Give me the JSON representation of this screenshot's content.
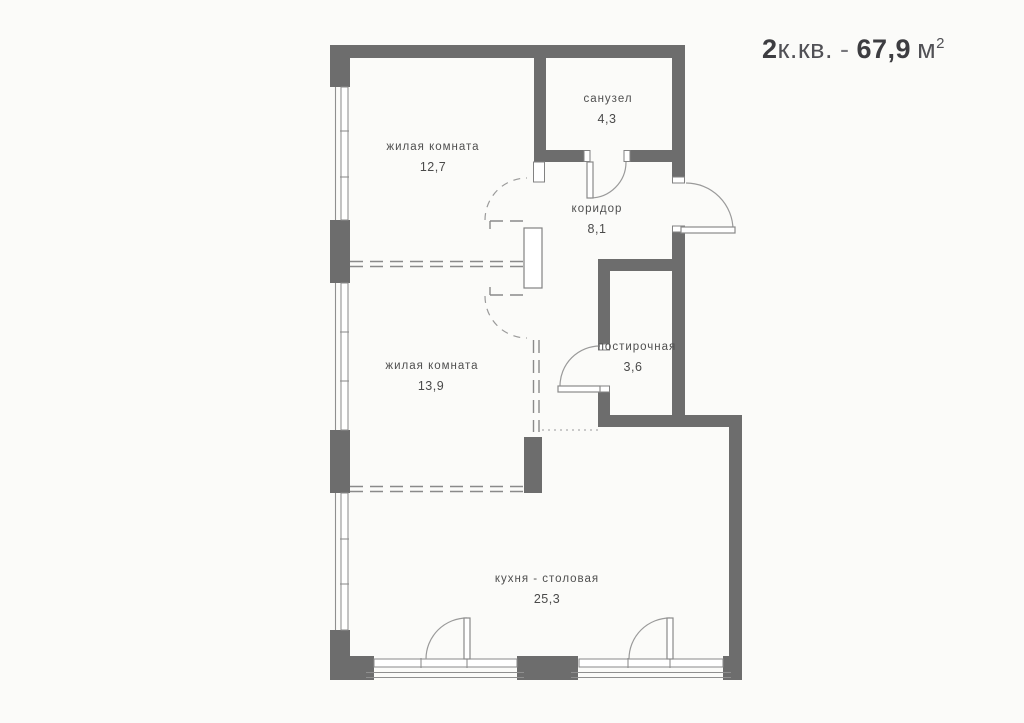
{
  "title": {
    "rooms_count": "2",
    "type_label": "к.кв.",
    "separator": "-",
    "area_value": "67,9",
    "area_unit": "м",
    "area_sup": "2"
  },
  "rooms": [
    {
      "name": "жилая комната",
      "area": "12,7"
    },
    {
      "name": "санузел",
      "area": "4,3"
    },
    {
      "name": "коридор",
      "area": "8,1"
    },
    {
      "name": "жилая комната",
      "area": "13,9"
    },
    {
      "name": "постирочная",
      "area": "3,6"
    },
    {
      "name": "кухня - столовая",
      "area": "25,3"
    }
  ],
  "colors": {
    "wall": "#6d6d6d",
    "thin_line": "#8a8a8a",
    "background": "#fbfbf9",
    "text": "#4f4f4f"
  }
}
